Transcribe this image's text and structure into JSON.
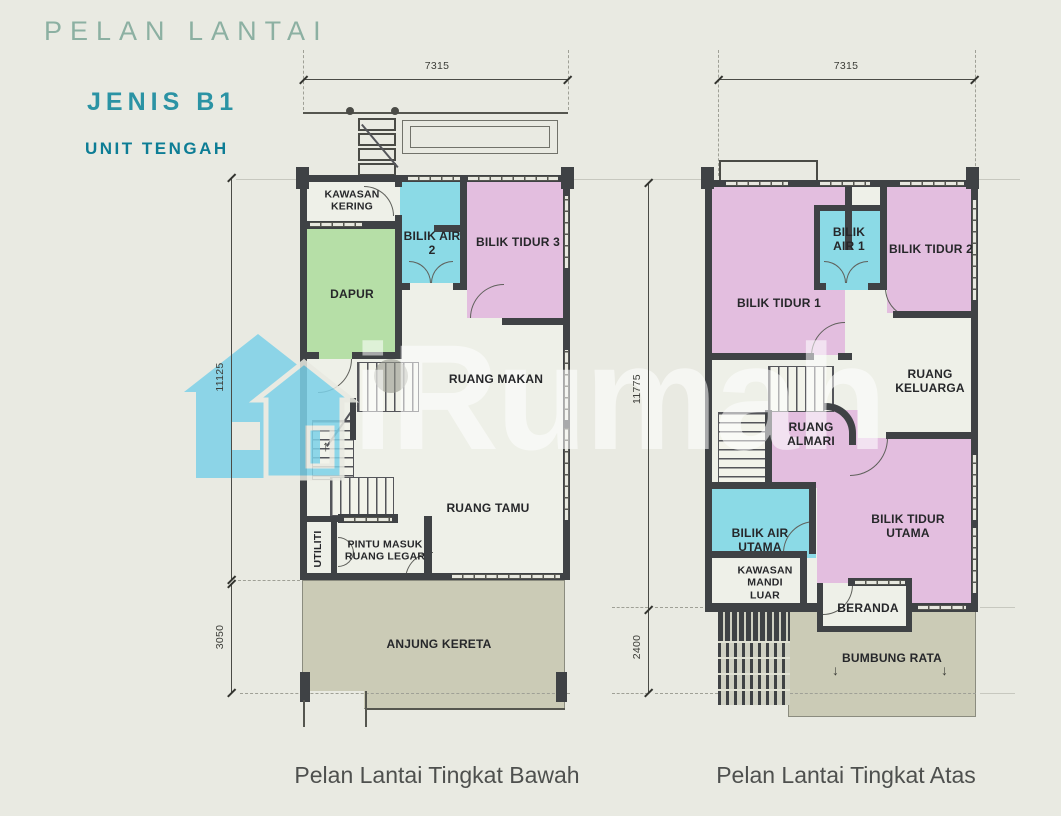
{
  "header": {
    "title": "PELAN LANTAI",
    "type": "JENIS B1",
    "unit": "UNIT TENGAH"
  },
  "watermark": {
    "brand": "iRumah"
  },
  "captions": {
    "ground": "Pelan Lantai Tingkat Bawah",
    "upper": "Pelan Lantai Tingkat Atas"
  },
  "ground_floor": {
    "dim_width": "7315",
    "dim_height_main": "11125",
    "dim_height_porch": "3050",
    "stair_arrow": "↑",
    "rooms": {
      "kawasan_kering": "KAWASAN\nKERING",
      "dapur": "DAPUR",
      "bilik_air_2": "BILIK AIR\n2",
      "bilik_tidur_3": "BILIK TIDUR 3",
      "ruang_makan": "RUANG MAKAN",
      "ruang_tamu": "RUANG TAMU",
      "utiliti": "UTILITI",
      "ruang_legar": "PINTU MASUK\nRUANG LEGAR",
      "anjung_kereta": "ANJUNG KERETA"
    }
  },
  "upper_floor": {
    "dim_width": "7315",
    "dim_height_main": "11775",
    "dim_height_porch": "2400",
    "roof_arrow": "↓",
    "rooms": {
      "bilik_tidur_1": "BILIK TIDUR 1",
      "bilik_air_1": "BILIK\nAIR 1",
      "bilik_tidur_2": "BILIK TIDUR 2",
      "ruang_keluarga": "RUANG\nKELUARGA",
      "ruang_almari": "RUANG\nALMARI",
      "bilik_air_utama": "BILIK AIR\nUTAMA",
      "bilik_tidur_utama": "BILIK TIDUR\nUTAMA",
      "kawasan_mandi_luar": "KAWASAN\nMANDI\nLUAR",
      "beranda": "BERANDA",
      "bumbung_rata": "BUMBUNG RATA"
    }
  },
  "colors": {
    "background": "#e9eae2",
    "wall": "#3f4245",
    "floor": "#eef0e8",
    "bedroom_pink": "#e3bedf",
    "bathroom_cyan": "#8bdae6",
    "kitchen_green": "#b6dfa7",
    "porch_olive": "#cbcbb6",
    "title_sage": "#8cb0a2",
    "accent_teal": "#2b93a4",
    "accent_dark_teal": "#0d7d95",
    "watermark_blue": "#7cd1e8"
  }
}
